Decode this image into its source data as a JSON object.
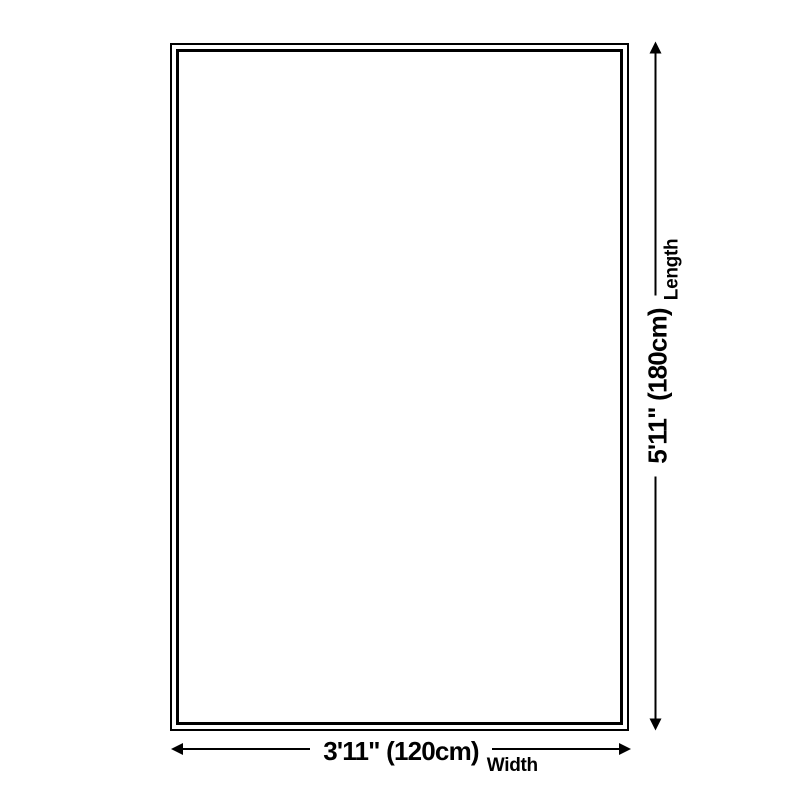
{
  "diagram": {
    "background_color": "#ffffff",
    "line_color": "#000000",
    "shape": "rectangle-double-border",
    "length_dimension": {
      "value": "5'11\" (180cm)",
      "label": "Length",
      "orientation": "vertical"
    },
    "width_dimension": {
      "value": "3'11\" (120cm)",
      "label": "Width",
      "orientation": "horizontal"
    }
  }
}
